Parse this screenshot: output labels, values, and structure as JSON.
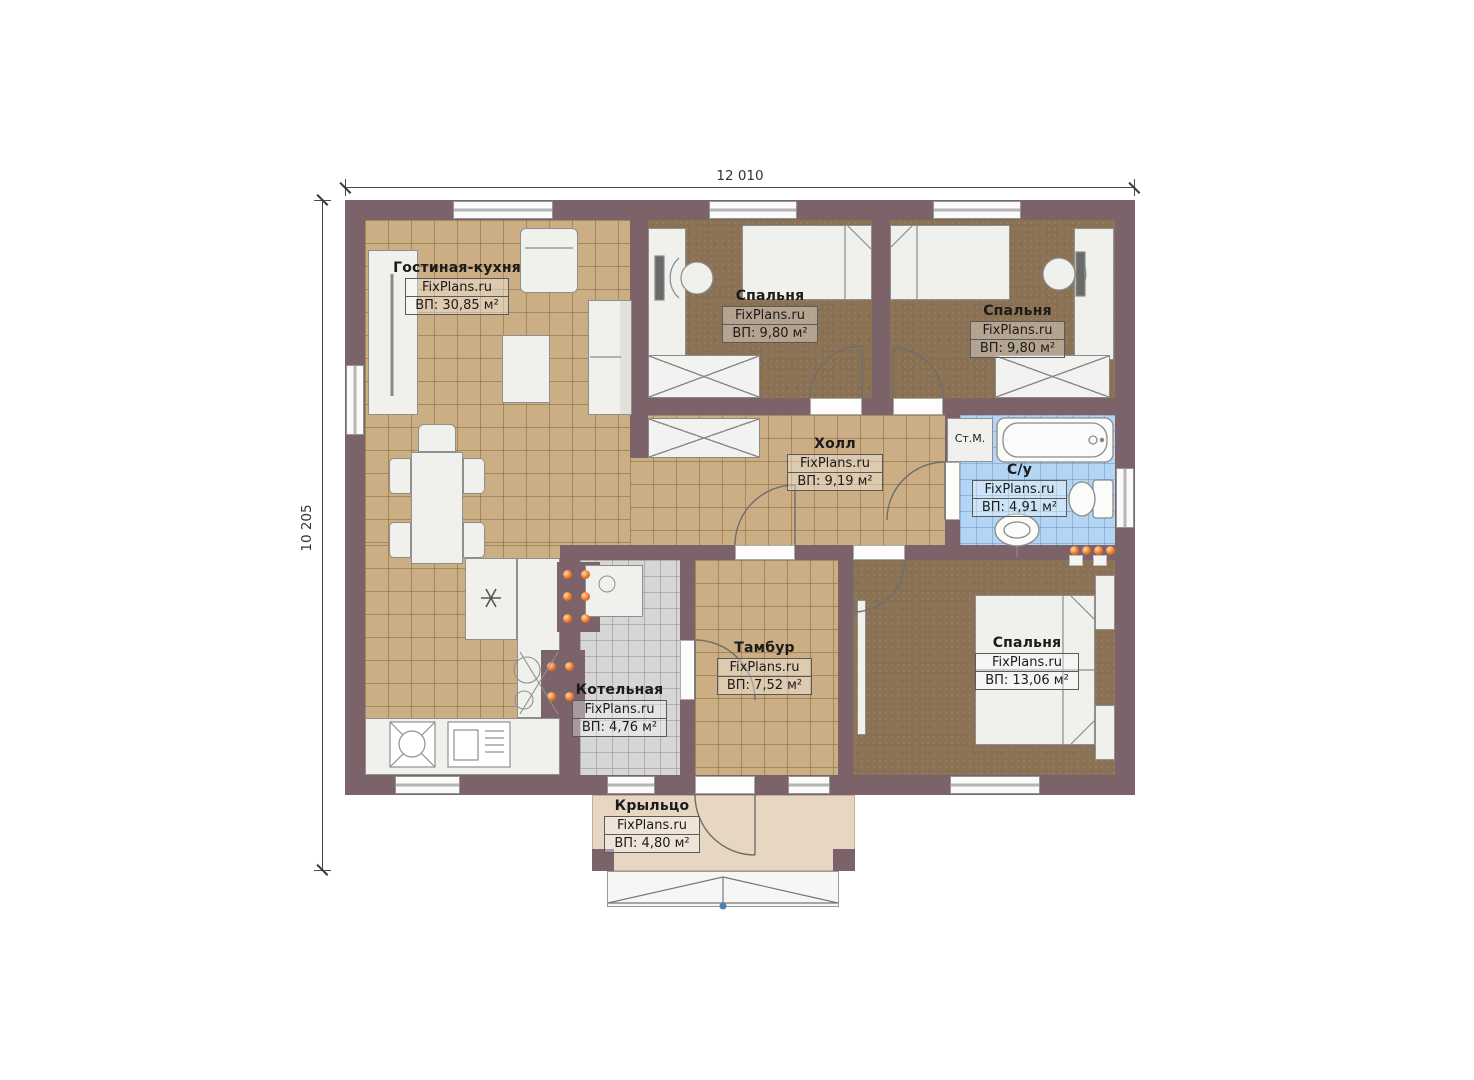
{
  "watermark": "FixPlans.ru",
  "dimensions": {
    "width_label": "12 010",
    "height_label": "10 205"
  },
  "rooms": {
    "living": {
      "name": "Гостиная-кухня",
      "area": "ВП: 30,85 м²"
    },
    "bedroom1": {
      "name": "Спальня",
      "area": "ВП: 9,80 м²"
    },
    "bedroom2": {
      "name": "Спальня",
      "area": "ВП: 9,80 м²"
    },
    "hall": {
      "name": "Холл",
      "area": "ВП: 9,19 м²"
    },
    "bathroom": {
      "name": "С/у",
      "area": "ВП: 4,91 м²"
    },
    "boiler": {
      "name": "Котельная",
      "area": "ВП: 4,76 м²"
    },
    "tambour": {
      "name": "Тамбур",
      "area": "ВП: 7,52 м²"
    },
    "bedroom3": {
      "name": "Спальня",
      "area": "ВП: 13,06 м²"
    },
    "porch": {
      "name": "Крыльцо",
      "area": "ВП: 4,80 м²"
    }
  },
  "labels": {
    "washing_machine": "Ст.М."
  },
  "colors": {
    "wall": "#7b6369",
    "floor_tile_tan": "#cbae84",
    "bedroom_carpet": "#8b7254",
    "bathroom_tile_blue": "#b3d6f5",
    "boiler_tile_gray": "#d6d6d6",
    "porch_beige": "#e6d6c2",
    "burner_orange": "#ef7724",
    "entry_marker_blue": "#4a7fb5"
  }
}
